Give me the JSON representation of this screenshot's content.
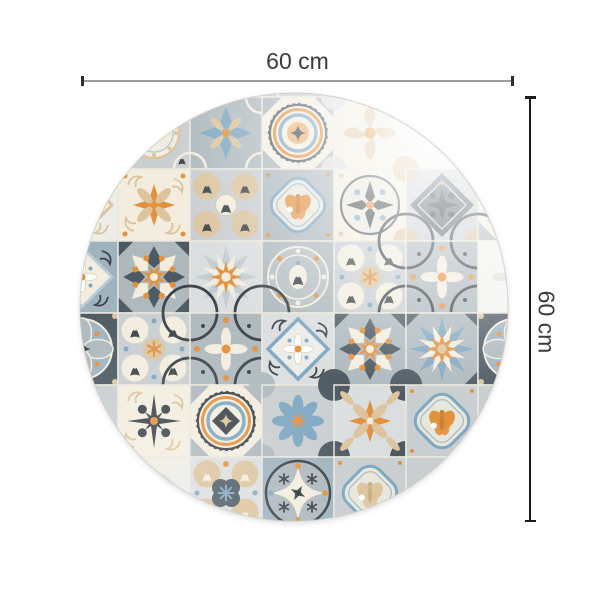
{
  "dimensions": {
    "width": {
      "label": "60 cm"
    },
    "height": {
      "label": "60 cm"
    }
  },
  "mat": {
    "type": "round-vinyl-tile-mat",
    "pattern": "azulejo-patchwork",
    "circle": {
      "cx": 294,
      "cy": 307,
      "r": 214
    },
    "grid": {
      "cols": 7,
      "rows": 7,
      "cell": 72,
      "origin_x": 46,
      "origin_y": 25
    },
    "palette": {
      "cream": "#f2edde",
      "offwhite": "#edece6",
      "paleGray": "#dbdedf",
      "lightGray": "#c9ced1",
      "midGray": "#aeb9be",
      "grayBlue": "#9fb3bf",
      "slate": "#4e5a63",
      "charcoal": "#3d4449",
      "black": "#26292c",
      "orange": "#e2913f",
      "lightOrange": "#eab273",
      "tan": "#dcc49e",
      "blue": "#7ea7c1",
      "paleBlue": "#b7ccd8",
      "grout": "#eae7de",
      "white": "#ffffff"
    },
    "tiles": [
      [
        [
          "plain",
          1
        ],
        [
          "scrollCircle",
          1
        ],
        [
          "circlesFleur",
          0
        ],
        [
          "plain",
          1
        ],
        [
          "flower8",
          0
        ],
        [
          "plain",
          2
        ],
        [
          "plain",
          1
        ]
      ],
      [
        [
          "plain",
          1
        ],
        [
          "scrollCircle",
          1
        ],
        [
          "flower4",
          0
        ],
        [
          "medallion",
          0
        ],
        [
          "flower8",
          0
        ],
        [
          "plain",
          2
        ],
        [
          "quatrefoil",
          2
        ]
      ],
      [
        [
          "diamondTile",
          1
        ],
        [
          "crossLeaves",
          0
        ],
        [
          "circlesFleur",
          2
        ],
        [
          "quatrefoil",
          0
        ],
        [
          "compass",
          0
        ],
        [
          "darkDiamond",
          0
        ],
        [
          "medallion",
          1
        ]
      ],
      [
        [
          "diamondTile",
          2
        ],
        [
          "star8",
          0
        ],
        [
          "pinwheel",
          0
        ],
        [
          "circleDiamond",
          1
        ],
        [
          "circlesFleur",
          0
        ],
        [
          "curvedX",
          0
        ],
        [
          "plain",
          2
        ]
      ],
      [
        [
          "scrollCircle",
          0
        ],
        [
          "circlesFleur",
          0
        ],
        [
          "curvedX",
          0
        ],
        [
          "diamondTile",
          0
        ],
        [
          "star8",
          0
        ],
        [
          "pinwheel",
          1
        ],
        [
          "scrollCircle",
          0
        ]
      ],
      [
        [
          "plain",
          1
        ],
        [
          "darkStar",
          0
        ],
        [
          "medallion",
          2
        ],
        [
          "flower8",
          1
        ],
        [
          "crossLeaves",
          1
        ],
        [
          "quatrefoil",
          1
        ],
        [
          "plain",
          1
        ]
      ],
      [
        [
          "plain",
          2
        ],
        [
          "plain",
          0
        ],
        [
          "circlesFleur",
          1
        ],
        [
          "circleDiamond",
          0
        ],
        [
          "quatrefoil",
          3
        ],
        [
          "plain",
          1
        ],
        [
          "plain",
          0
        ]
      ]
    ]
  }
}
